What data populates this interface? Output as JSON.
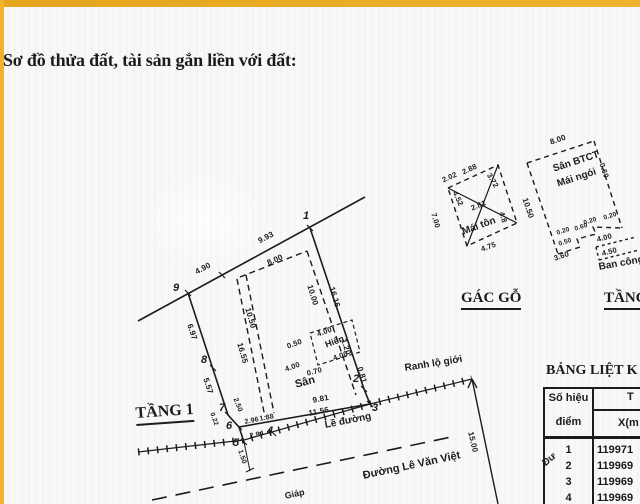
{
  "title": "Sơ đồ thửa đất, tài sản gắn liền với đất:",
  "colors": {
    "accent": "#f0b32b",
    "ink": "#1c1c1c",
    "paper": "#f8f8f7"
  },
  "floor1": {
    "heading": "TẦNG 1",
    "points": {
      "p1": "1",
      "p2": "2",
      "p3": "3",
      "p4": "4",
      "p5": "5",
      "p6": "6",
      "p7": "7",
      "p8": "8",
      "p9": "9"
    },
    "measures": {
      "top_a": "4.90",
      "top_b": "9.93",
      "left_a": "6.97",
      "left_b": "5.57",
      "right_a": "16.16",
      "right_b": "1.20",
      "right_c": "0.81",
      "house_top": "8.00",
      "house_right": "10.00",
      "house_left_a": "10.50",
      "house_left_b": "16.55",
      "porch_a": "0.50",
      "porch_b": "4.00",
      "porch_c": "4.00",
      "porch_d": "4.00",
      "porch_e": "0.70",
      "bottom_a": "2.50",
      "bottom_b": "0.22",
      "bottom_c": "2.96",
      "bottom_d": "1.88",
      "bottom_e": "2.94",
      "bottom_f": "1.50",
      "road_a": "9.81",
      "road_b": "11.56",
      "offset": "15.00"
    },
    "labels": {
      "yard": "Sân",
      "porch": "Hiên",
      "curb": "Lề đường",
      "road_boundary": "Ranh lộ giới",
      "street": "Đường Lê Văn Việt",
      "street_frag": "Đư",
      "giap": "Giáp"
    }
  },
  "attic": {
    "heading": "GÁC GỖ",
    "roof": "Mái tôn",
    "measures": {
      "a": "2.02",
      "b": "2.88",
      "c": "3.72",
      "d": "4.52",
      "e": "2.81",
      "f": "7.00",
      "g": "4.8",
      "h": "4.75"
    }
  },
  "upper": {
    "heading": "TẦNG",
    "label1": "Sân BTCT",
    "label2": "Mái ngói",
    "balcony": "Ban công",
    "measures": {
      "top": "8.00",
      "left": "10.50",
      "right": "0.60",
      "s1": "0.20",
      "s2": "0.20",
      "s3": "0.20",
      "s4": "0.60",
      "s5": "0.50",
      "s6": "3.60",
      "s7": "4.00",
      "s8": "4.50"
    }
  },
  "table": {
    "heading": "BẢNG LIỆT K",
    "col_point_l1": "Số hiệu",
    "col_point_l2": "điểm",
    "col2_top": "T",
    "col2_sub": "X(m",
    "rows": [
      {
        "point": "1",
        "x": "119971"
      },
      {
        "point": "2",
        "x": "119969"
      },
      {
        "point": "3",
        "x": "119969"
      },
      {
        "point": "4",
        "x": "119969"
      }
    ]
  }
}
